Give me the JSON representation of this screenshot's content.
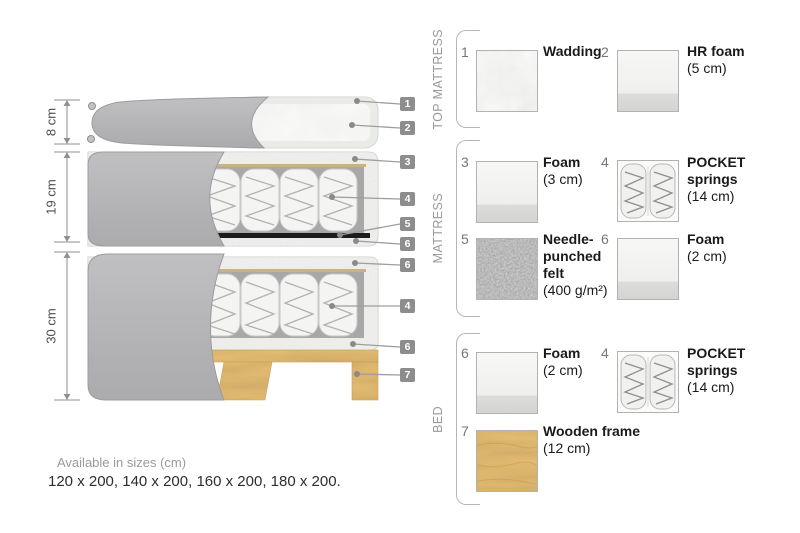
{
  "diagram": {
    "dimension_labels": [
      "8 cm",
      "19 cm",
      "30 cm"
    ],
    "callout_numbers": {
      "t1": "1",
      "t2": "2",
      "t3": "3",
      "t4": "4",
      "t5": "5",
      "t6": "6",
      "t6a": "6",
      "t4a": "4",
      "t6b": "6",
      "t7": "7"
    }
  },
  "legend": {
    "sections": [
      {
        "title": "TOP MATTRESS",
        "items": [
          {
            "num": "1",
            "label": "Wadding",
            "sub": "",
            "swatch": "wadding-texture"
          },
          {
            "num": "2",
            "label": "HR foam",
            "sub": "(5 cm)",
            "swatch": "foam-texture"
          }
        ]
      },
      {
        "title": "MATTRESS",
        "items": [
          {
            "num": "3",
            "label": "Foam",
            "sub": "(3 cm)",
            "swatch": "foam-texture"
          },
          {
            "num": "4",
            "label": "POCKET springs",
            "sub": "(14 cm)",
            "swatch": "pocket-springs-texture"
          },
          {
            "num": "5",
            "label": "Needle-punched felt",
            "sub": "(400 g/m²)",
            "swatch": "felt-texture"
          },
          {
            "num": "6",
            "label": "Foam",
            "sub": "(2 cm)",
            "swatch": "foam-texture"
          }
        ]
      },
      {
        "title": "BED",
        "items": [
          {
            "num": "6",
            "label": "Foam",
            "sub": "(2 cm)",
            "swatch": "foam-texture"
          },
          {
            "num": "4",
            "label": "POCKET springs",
            "sub": "(14 cm)",
            "swatch": "pocket-springs-texture"
          },
          {
            "num": "7",
            "label": "Wooden frame",
            "sub": "(12 cm)",
            "swatch": "wood-texture"
          }
        ]
      }
    ]
  },
  "footer": {
    "caption": "Available in sizes (cm)",
    "sizes": "120 x 200, 140 x 200, 160 x 200, 180 x 200."
  },
  "colors": {
    "cover_grey": "#b7b7ba",
    "foam_speckle": "#e8e8e6",
    "felt_black": "#1c1c1c",
    "wood_tan": "#ecc276",
    "tag_grey": "#8d8d8d",
    "label_grey": "#9a9a9a"
  }
}
